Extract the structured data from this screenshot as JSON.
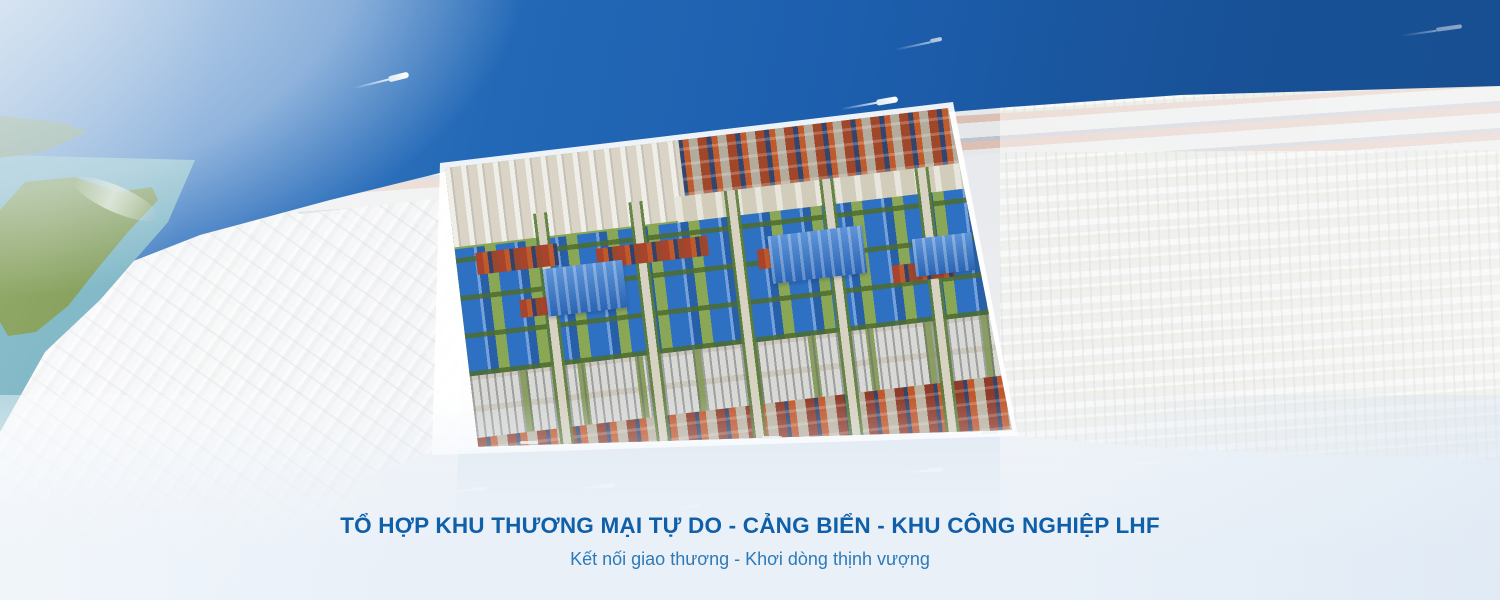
{
  "banner": {
    "title": "TỔ HỢP KHU THƯƠNG MẠI TỰ DO - CẢNG BIỂN - KHU CÔNG NGHIỆP LHF",
    "subtitle": "Kết nối giao thương - Khơi dòng thịnh vượng"
  },
  "scene": {
    "elements": [
      "sea",
      "container-terminal-quay",
      "green-island",
      "estuary",
      "city-districts",
      "highlighted-industrial-park",
      "river-channel",
      "ships",
      "boats"
    ]
  },
  "colors": {
    "sea_deep": "#174e90",
    "sea_main": "#1d5fae",
    "sea_haze": "#8fb2d6",
    "estuary_teal": "#6aabbc",
    "island_green": "#7e9a58",
    "city_base": "#dfe2e6",
    "park_green": "#8aa755",
    "roof_blue": "#2e70c2",
    "roof_blue_light": "#74a0dc",
    "container_orange": "#bf5a2d",
    "container_navy": "#32456e",
    "container_rust": "#8e3b2a",
    "warehouse_grey": "#d8d8d4",
    "river_blue": "#9db6cf",
    "boundary_white": "#ffffff",
    "fade_band": "#e9f0f8",
    "title_blue": "#0f5fa9",
    "subtitle_blue": "#2e7ab8"
  }
}
